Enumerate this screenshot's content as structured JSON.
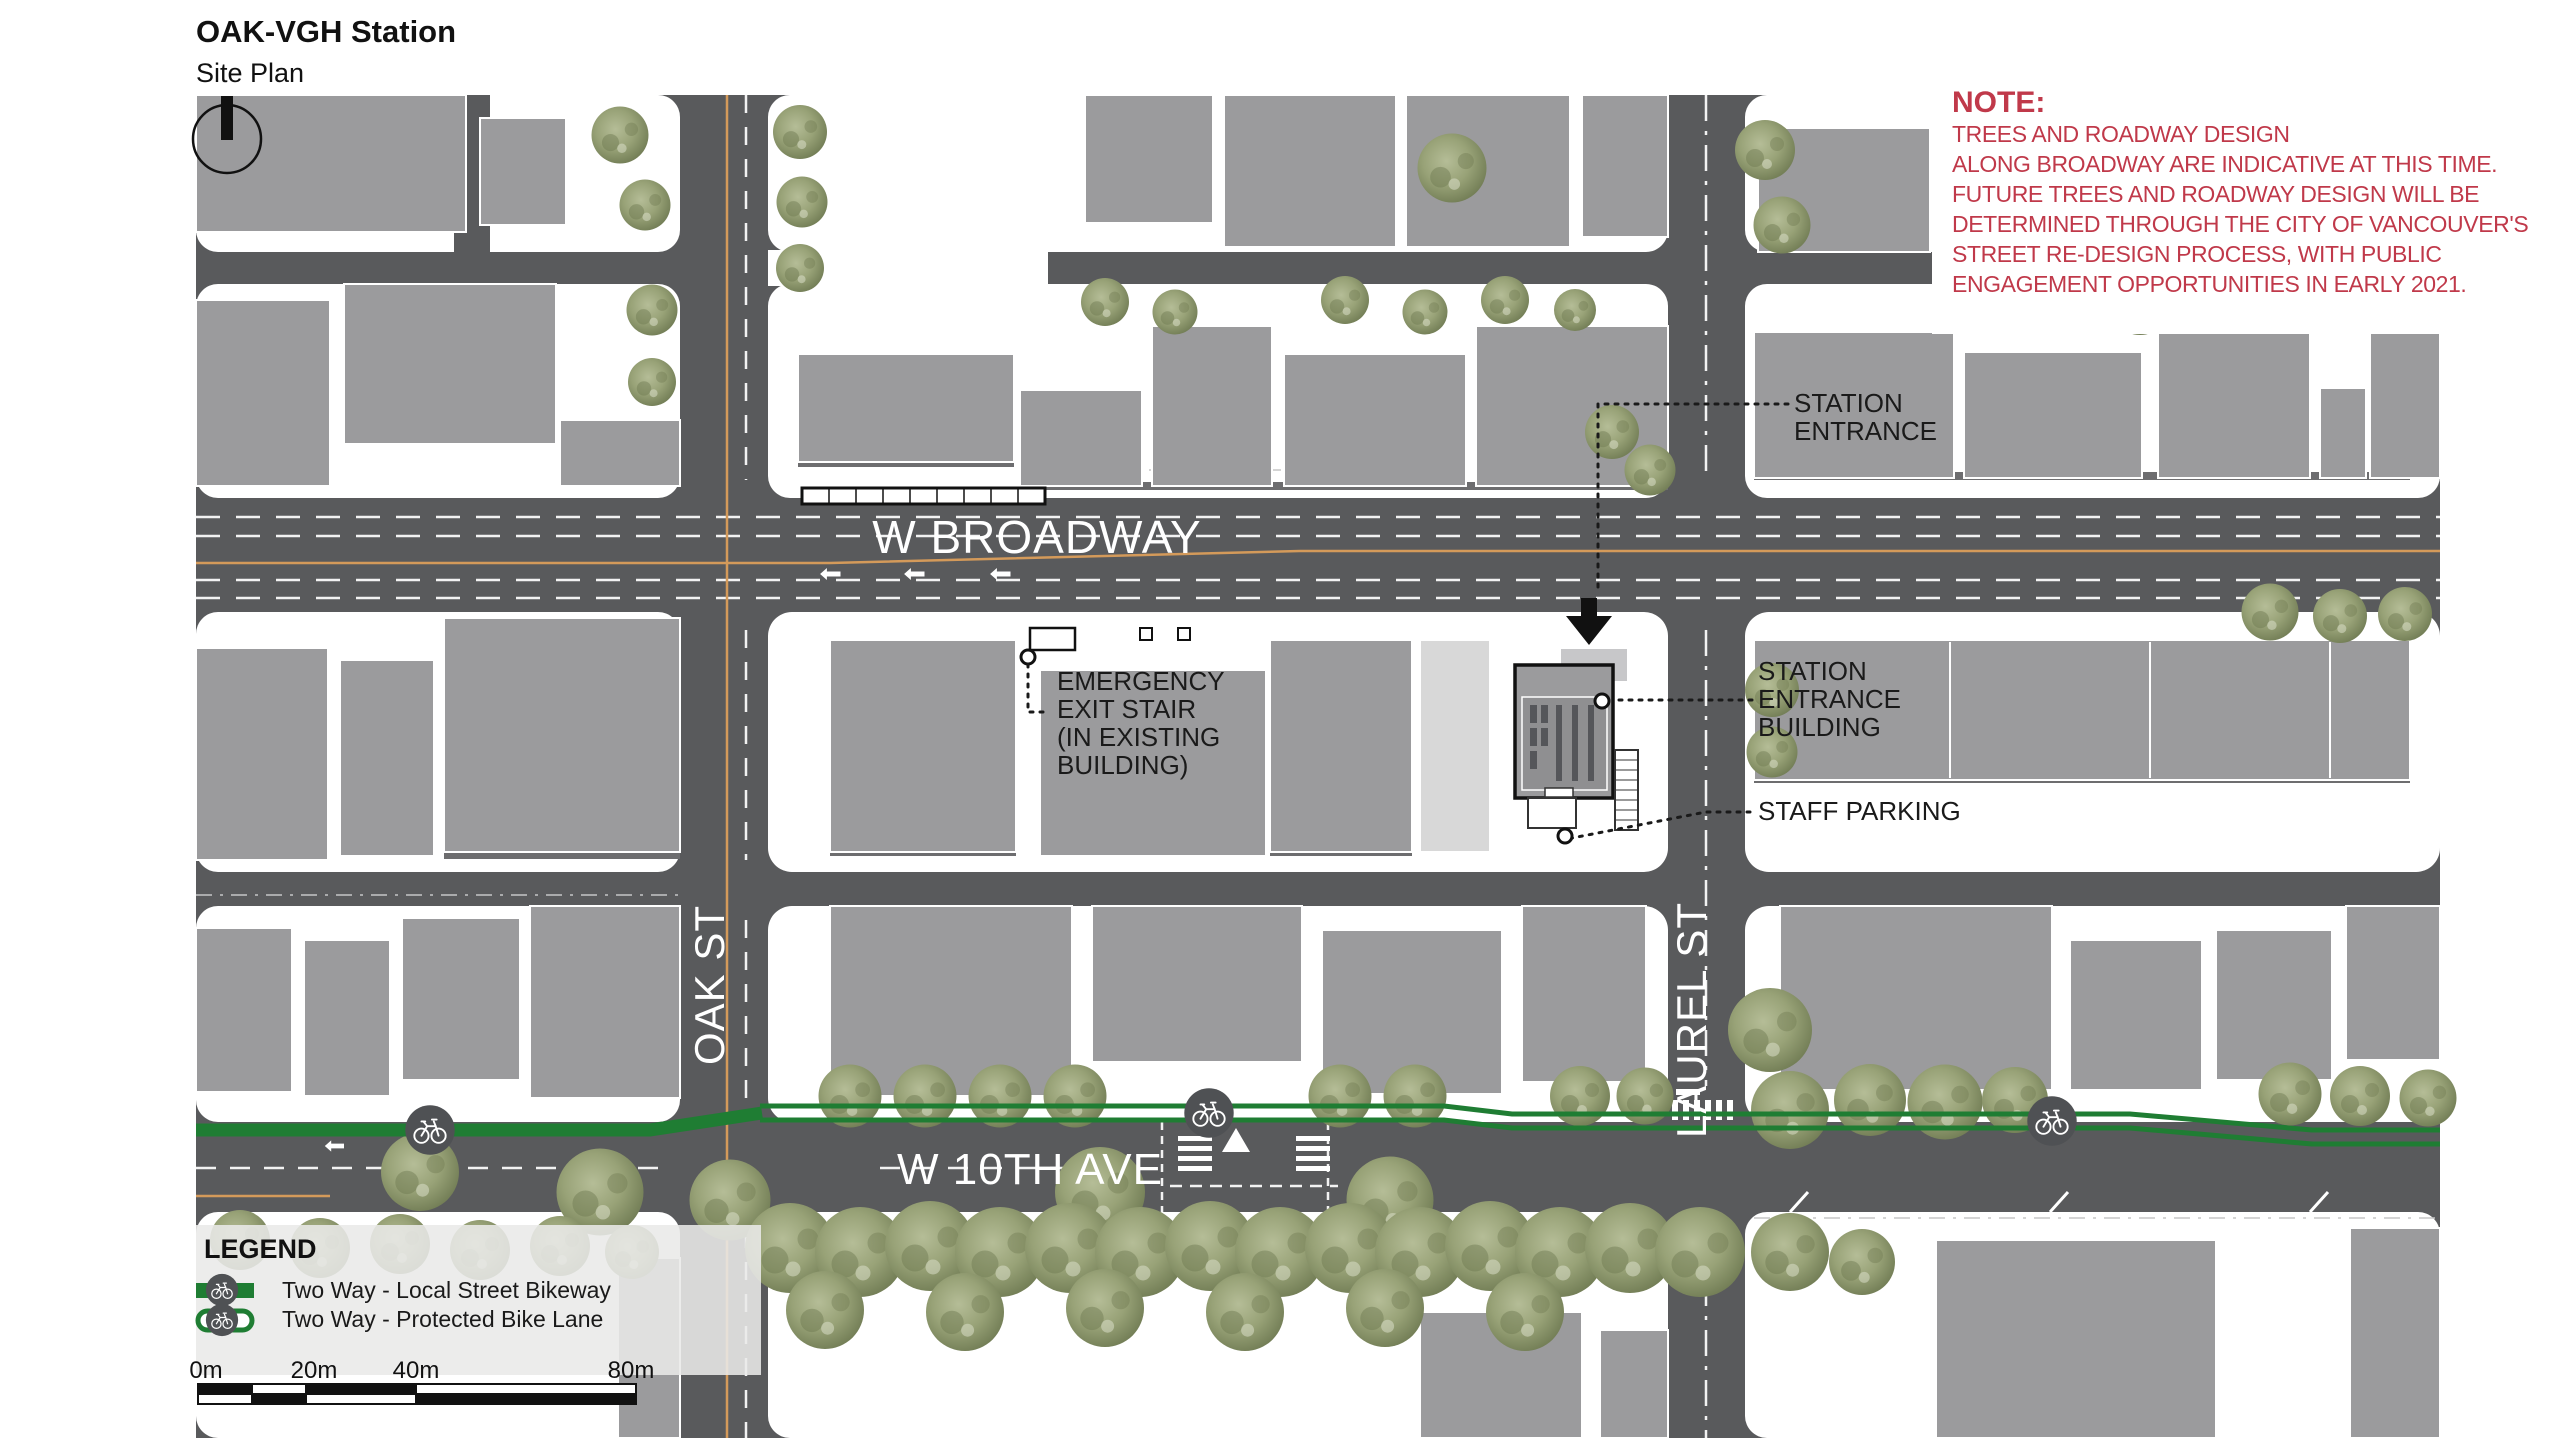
{
  "header": {
    "title": "OAK-VGH Station",
    "subtitle": "Site Plan"
  },
  "note": {
    "heading": "NOTE:",
    "lines": [
      "TREES AND ROADWAY DESIGN",
      "ALONG BROADWAY ARE INDICATIVE AT THIS TIME.",
      "FUTURE TREES AND ROADWAY DESIGN WILL BE",
      "DETERMINED THROUGH THE CITY OF VANCOUVER'S",
      "STREET RE-DESIGN PROCESS, WITH PUBLIC",
      "ENGAGEMENT OPPORTUNITIES IN EARLY 2021."
    ]
  },
  "streets": {
    "broadway": "W BROADWAY",
    "tenth_ave": "W 10TH AVE",
    "oak": "OAK ST",
    "laurel": "LAUREL ST"
  },
  "annotations": {
    "station_entrance": {
      "line1": "STATION",
      "line2": "ENTRANCE"
    },
    "station_entrance_building": {
      "line1": "STATION",
      "line2": "ENTRANCE",
      "line3": "BUILDING"
    },
    "emergency_exit": {
      "line1": "EMERGENCY",
      "line2": "EXIT STAIR",
      "line3": "(IN EXISTING",
      "line4": "BUILDING)"
    },
    "staff_parking": "STAFF PARKING"
  },
  "legend": {
    "heading": "LEGEND",
    "items": [
      {
        "label": "Two Way - Local Street Bikeway",
        "symbol": "solid-green-bikeway"
      },
      {
        "label": "Two Way - Protected Bike Lane",
        "symbol": "outlined-green-bike-lane"
      }
    ]
  },
  "scale_bar": {
    "labels": [
      "0m",
      "20m",
      "40m",
      "80m"
    ]
  },
  "colors": {
    "road": "#595a5c",
    "building": "#9b9b9d",
    "building_light": "#d8d8d8",
    "tree_green": "#9aa47d",
    "bikeway_green": "#1f7d33",
    "note_red": "#c0394a",
    "centerline_orange": "#d49a5a"
  }
}
